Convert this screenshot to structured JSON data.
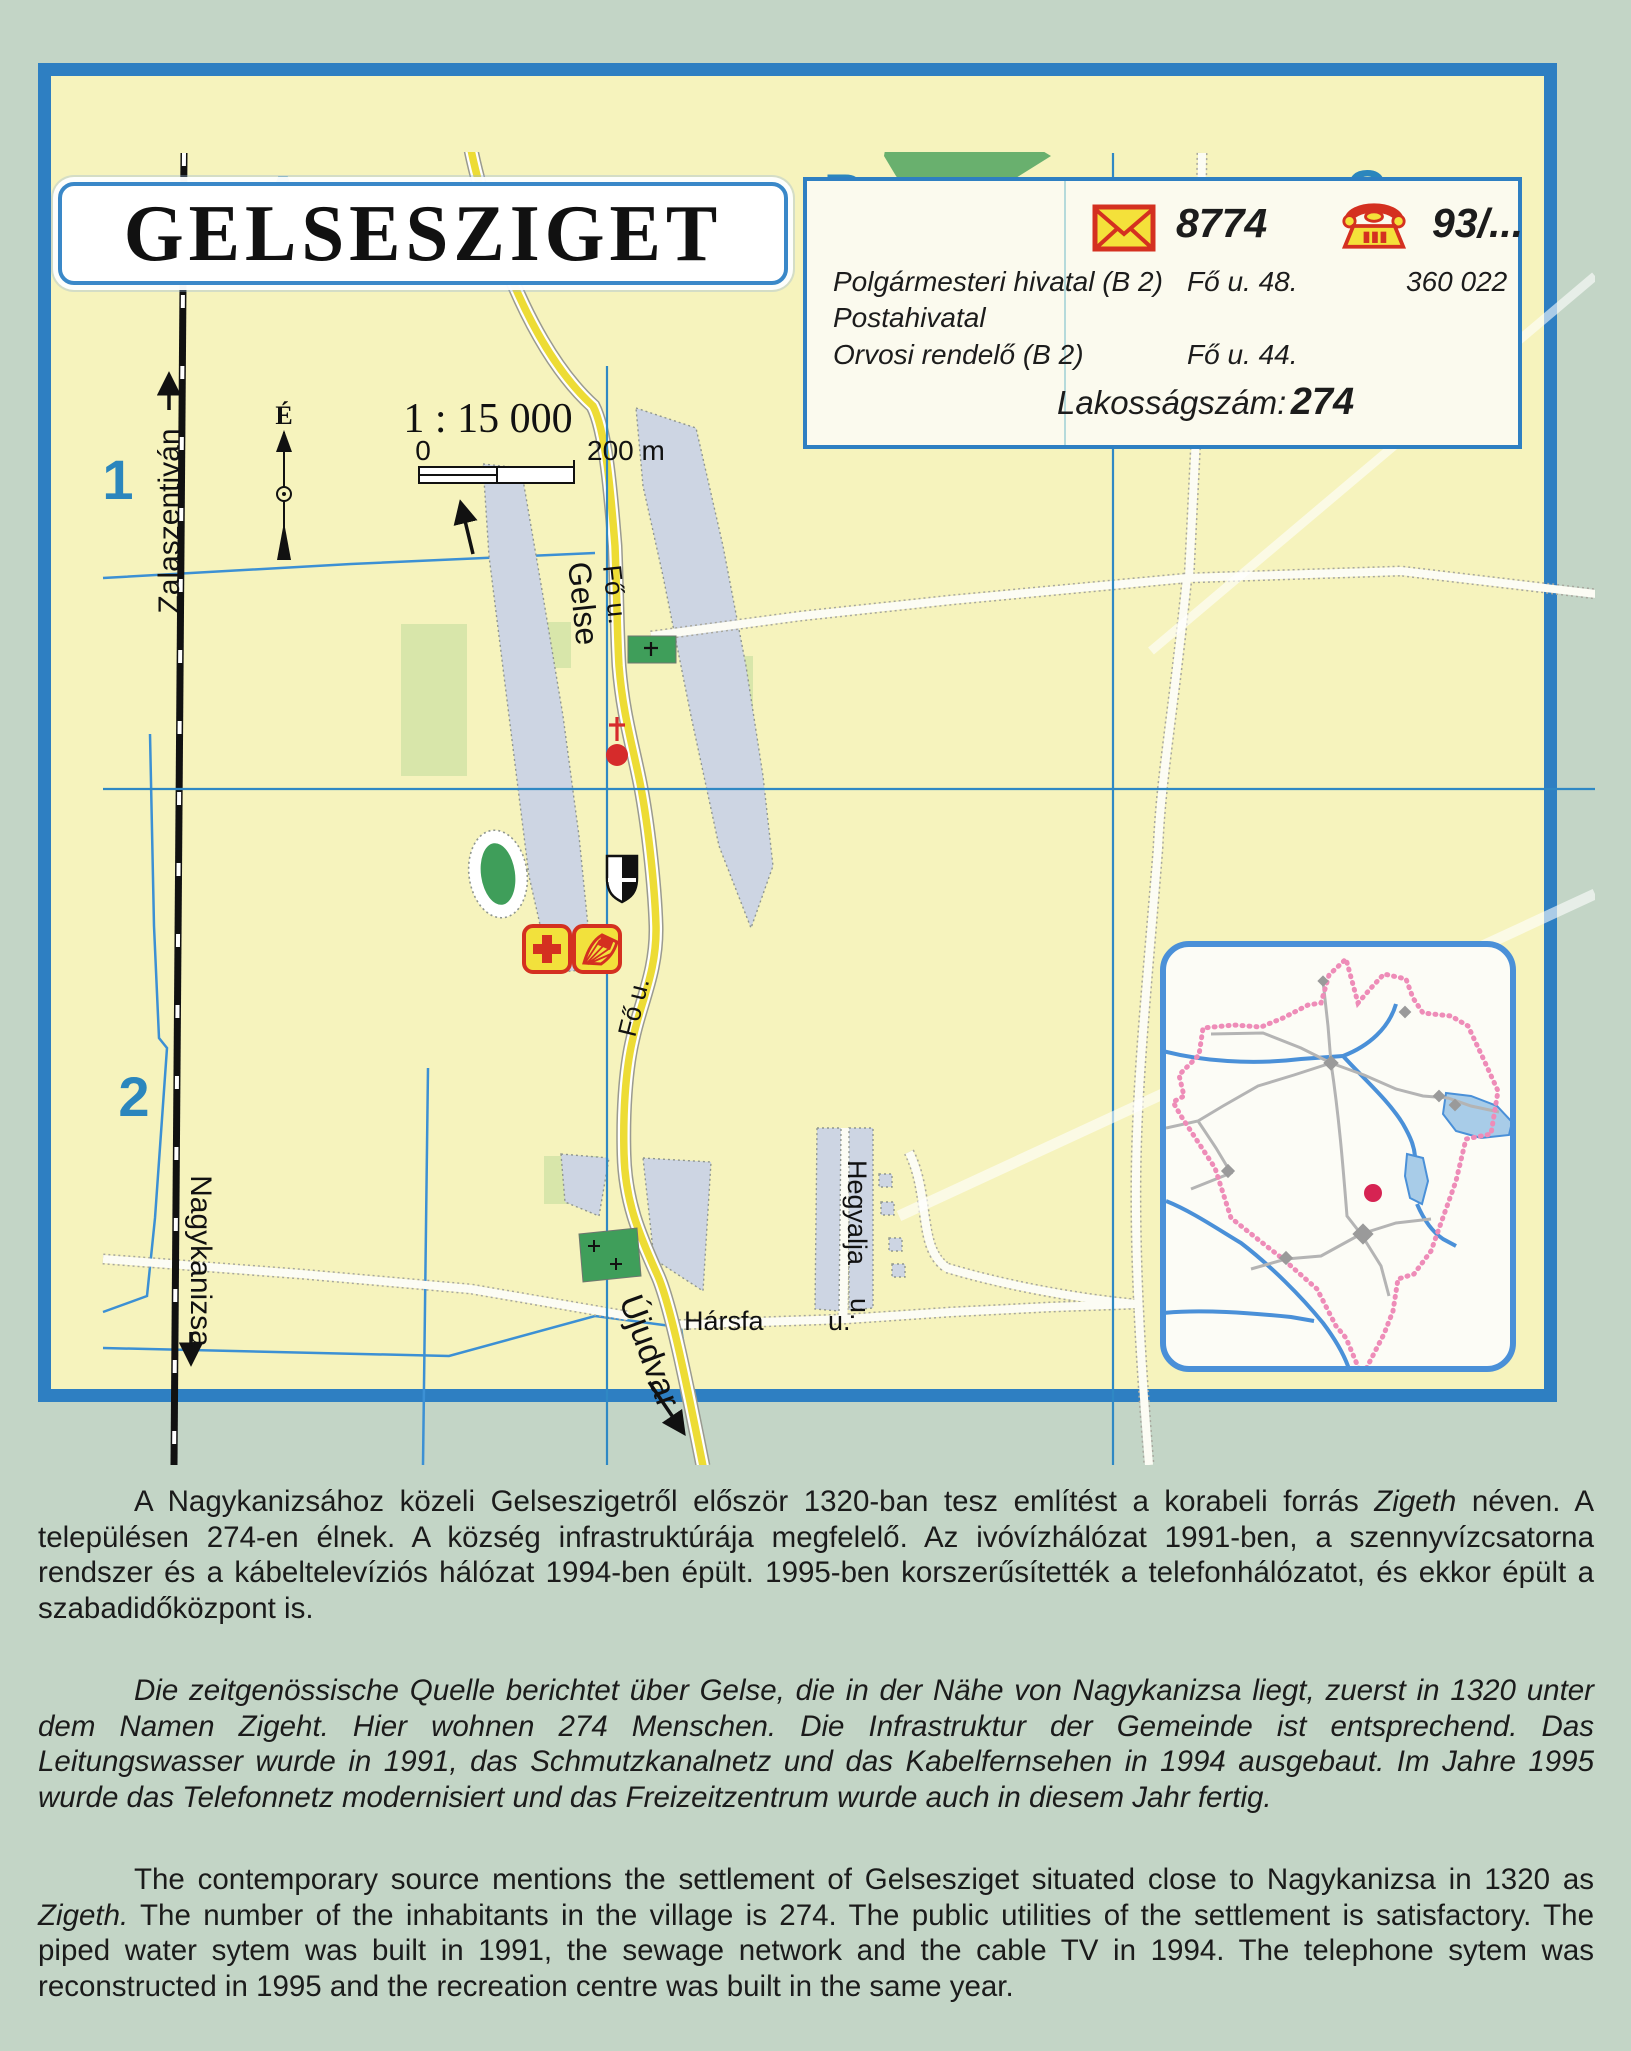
{
  "page": {
    "background": "#c3d5c6"
  },
  "map": {
    "title": "GELSESZIGET",
    "grid": {
      "cols": [
        "A",
        "B",
        "C"
      ],
      "rows": [
        "1",
        "2"
      ]
    },
    "scale": {
      "ratio": "1 : 15 000",
      "zero": "0",
      "end": "200 m",
      "north": "É"
    },
    "railway": {
      "to_north": "Zalaszentiván",
      "to_south": "Nagykanizsa"
    },
    "roads": {
      "fo_u": "Fő u.",
      "to_north": "Gelse",
      "to_south": "Újudvar",
      "harsfa": "Hársfa",
      "harsfa_u": "u.",
      "hegyalja": "Hegyalja",
      "hegyalja_u": "u."
    },
    "icons": {
      "postal": "envelope-icon",
      "phone": "rotary-phone-icon",
      "medical": "red-cross-icon",
      "library": "open-book-icon",
      "church": "church-icon",
      "town_hall": "shield-icon",
      "north": "north-arrow-icon",
      "cemetery": "cross-icon"
    },
    "colors": {
      "map_bg": "#f6f3bd",
      "border_blue": "#2e7fc2",
      "road_yellow": "#eddc35",
      "builtup": "#cdd5e3",
      "green": "#3f9e5a",
      "pale_green": "#d8e6aa",
      "accent_red": "#d43020",
      "inset_pink": "#ee8cb8",
      "water_blue": "#4a90d8",
      "label_blue": "#2b86bd"
    }
  },
  "infobox": {
    "postal_code": "8774",
    "phone_prefix": "93/...",
    "entries": [
      {
        "name": "Polgármesteri hivatal (B 2)",
        "address": "Fő u. 48.",
        "phone": "360 022"
      },
      {
        "name": "Postahivatal",
        "address": "",
        "phone": ""
      },
      {
        "name": "Orvosi rendelő (B 2)",
        "address": "Fő u. 44.",
        "phone": ""
      }
    ],
    "population_label": "Lakosságszám:",
    "population_value": "274"
  },
  "paragraphs": {
    "hu": {
      "pre": "A Nagykanizsához közeli Gelseszigetről először 1320-ban tesz említést a korabeli forrás ",
      "italic": "Zigeth",
      "post": " néven. A településen 274-en élnek. A község infrastruktúrája megfelelő. Az ivóvízhálózat 1991-ben, a szennyvízcsatorna rendszer és a kábeltelevíziós hálózat 1994-ben épült. 1995-ben korszerűsítették a telefonhálózatot, és ekkor épült a szabadidőközpont is."
    },
    "de": {
      "text": "Die zeitgenössische Quelle berichtet über Gelse, die in der Nähe von Nagykanizsa liegt, zuerst in 1320 unter dem Namen Zigeht. Hier wohnen 274 Menschen. Die Infrastruktur der Gemeinde ist entsprechend. Das Leitungswasser wurde in 1991, das Schmutzkanalnetz und das Kabelfernsehen in 1994 ausgebaut. Im Jahre 1995 wurde das Telefonnetz modernisiert und das Freizeitzentrum wurde auch in diesem Jahr fertig."
    },
    "en": {
      "pre": "The contemporary source mentions the settlement of Gelsesziget situated close to Nagykanizsa in 1320 as ",
      "italic": "Zigeth.",
      "post": " The number of the inhabitants in the village is 274. The public utilities of the settlement is satisfactory. The piped water sytem was built in 1991, the sewage network and the cable TV in 1994. The telephone sytem was reconstructed in 1995 and the recreation centre was built in the same year."
    }
  }
}
